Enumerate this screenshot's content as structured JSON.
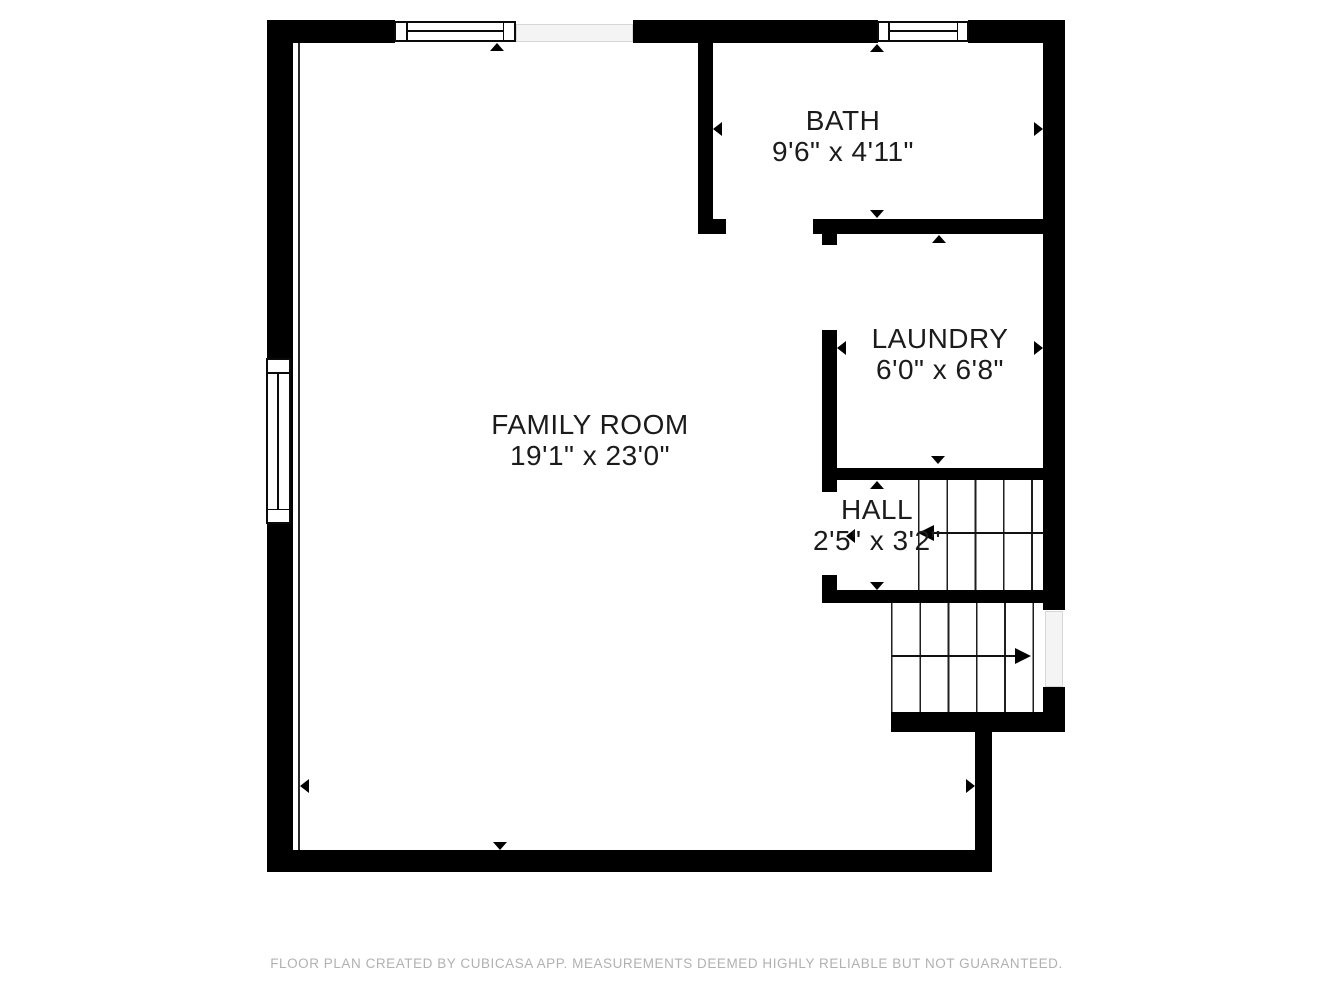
{
  "plan": {
    "rooms": {
      "family": {
        "name": "FAMILY ROOM",
        "dims": "19'1\" x 23'0\""
      },
      "bath": {
        "name": "BATH",
        "dims": "9'6\" x 4'11\""
      },
      "laundry": {
        "name": "LAUNDRY",
        "dims": "6'0\" x 6'8\""
      },
      "hall": {
        "name": "HALL",
        "dims": "2'5\" x 3'2\""
      }
    },
    "footer": "FLOOR PLAN CREATED BY CUBICASA APP. MEASUREMENTS DEEMED HIGHLY RELIABLE BUT NOT GUARANTEED.",
    "colors": {
      "wall": "#000000",
      "background": "#ffffff",
      "footer_text": "#b1b1b1",
      "opening_fill": "#f4f4f4",
      "stair_line": "#1f1f1f",
      "label_text": "#1b1b1b"
    }
  }
}
